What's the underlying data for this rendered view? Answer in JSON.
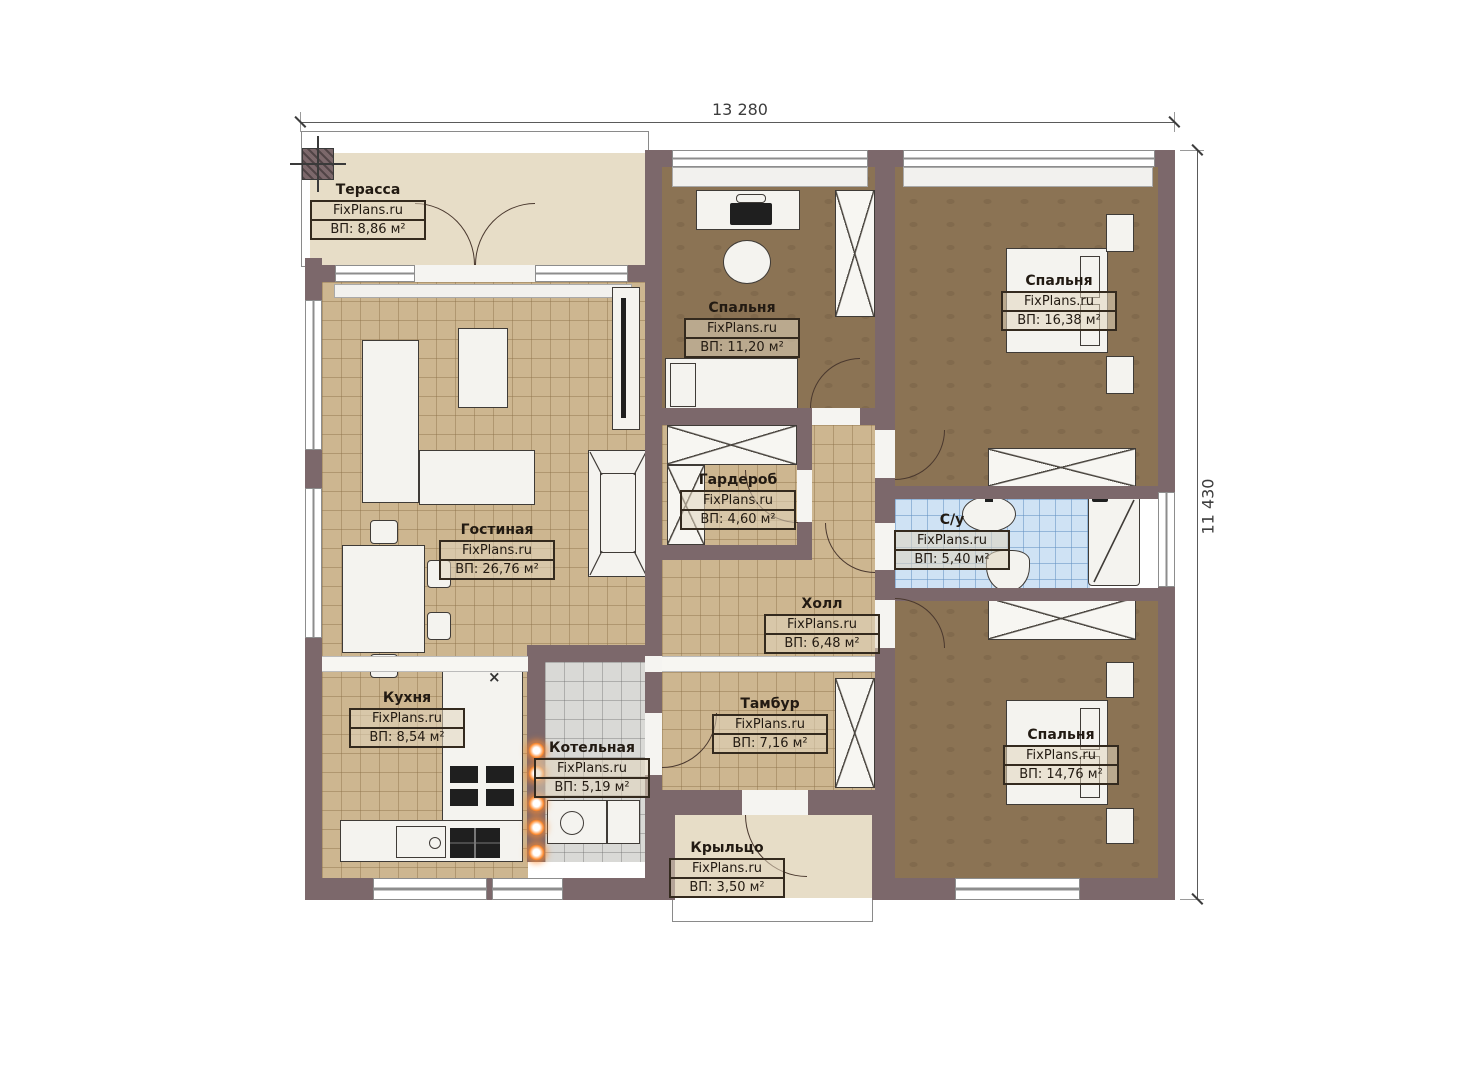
{
  "dimensions": {
    "width_label": "13 280",
    "height_label": "11 430"
  },
  "rooms": {
    "terrace": {
      "name": "Терасса",
      "watermark": "FixPlans.ru",
      "area": "ВП: 8,86 м²"
    },
    "living_room": {
      "name": "Гостиная",
      "watermark": "FixPlans.ru",
      "area": "ВП: 26,76 м²"
    },
    "kitchen": {
      "name": "Кухня",
      "watermark": "FixPlans.ru",
      "area": "ВП: 8,54 м²"
    },
    "boiler_room": {
      "name": "Котельная",
      "watermark": "FixPlans.ru",
      "area": "ВП: 5,19 м²"
    },
    "bedroom_middle": {
      "name": "Спальня",
      "watermark": "FixPlans.ru",
      "area": "ВП: 11,20 м²"
    },
    "wardrobe_room": {
      "name": "Гардероб",
      "watermark": "FixPlans.ru",
      "area": "ВП: 4,60 м²"
    },
    "hall": {
      "name": "Холл",
      "watermark": "FixPlans.ru",
      "area": "ВП: 6,48 м²"
    },
    "vestibule": {
      "name": "Тамбур",
      "watermark": "FixPlans.ru",
      "area": "ВП: 7,16 м²"
    },
    "porch": {
      "name": "Крыльцо",
      "watermark": "FixPlans.ru",
      "area": "ВП: 3,50 м²"
    },
    "bedroom_top_right": {
      "name": "Спальня",
      "watermark": "FixPlans.ru",
      "area": "ВП: 16,38 м²"
    },
    "bathroom": {
      "name": "С/у",
      "watermark": "FixPlans.ru",
      "area": "ВП: 5,40 м²"
    },
    "bedroom_bottom_right": {
      "name": "Спальня",
      "watermark": "FixPlans.ru",
      "area": "ВП: 14,76 м²"
    }
  },
  "symbols": {
    "kitchen_sink_mark": "×"
  },
  "colors": {
    "wall": "#7c686b",
    "tile_tan": "#cdb690",
    "wood_floor": "#8b7354",
    "bath_tile": "#cfe2f4",
    "boiler_tile": "#d9d9d6",
    "deck": "#e7ddc7",
    "radiator_glow": "#ff8b2e"
  }
}
